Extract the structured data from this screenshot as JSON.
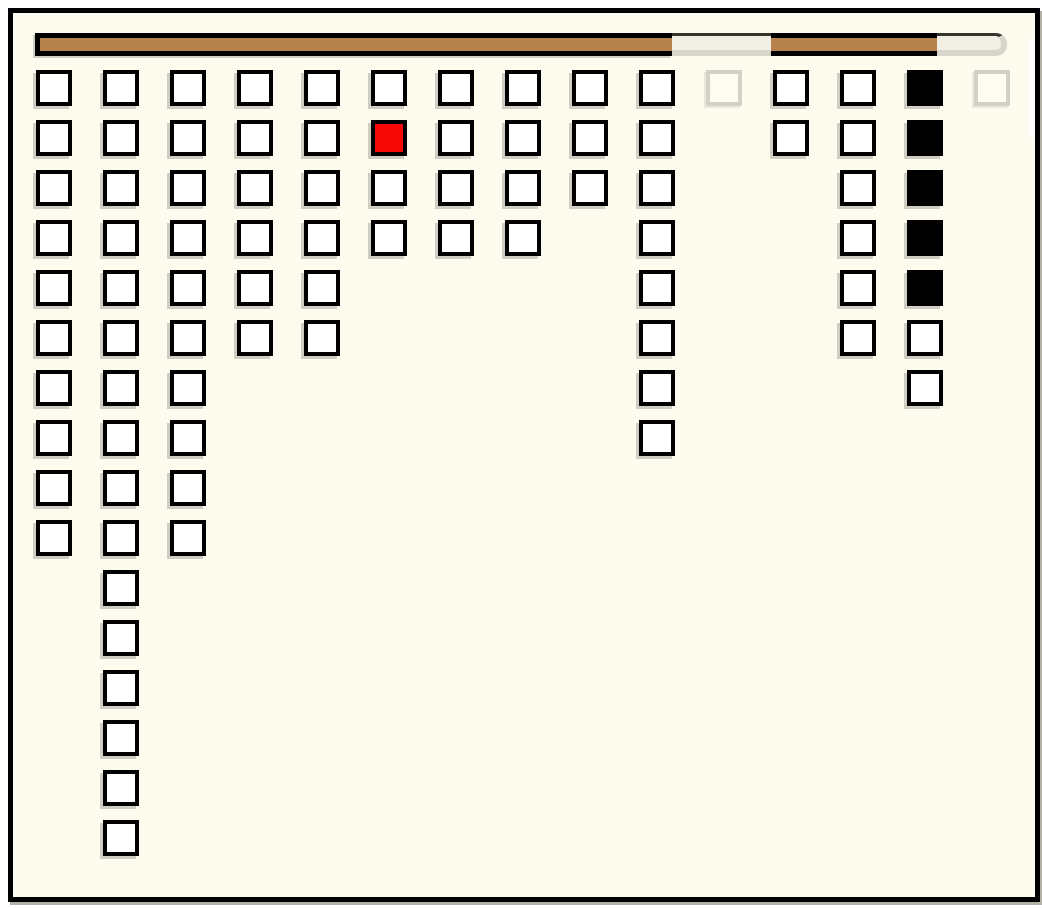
{
  "window": {
    "kind": "game-board",
    "text": ""
  },
  "colors": {
    "background": "#fcfbee",
    "outside": "#ffffff",
    "window_border": "#000000",
    "frame_shadow": "#b3b1a8",
    "cell_fill": "#ffffff",
    "cell_border": "#000000",
    "cell_red": "#f90808",
    "cell_black": "#000000",
    "ghost_border": "#d3d0c5",
    "ghost_fill": "#fdfcf1",
    "cell_shadow": "#d0cdc2",
    "bar_fill": "#b5824c",
    "bar_frame": "#000000",
    "track_fill": "#f1eee3",
    "track_rim": "#d8d5ca",
    "track_topline": "#35342f",
    "notch": "#ffffff"
  },
  "progress_bar": {
    "track": {
      "x": 35,
      "y": 33,
      "width": 972,
      "height": 23,
      "rounded_right_end": true
    },
    "segments": [
      {
        "type": "filled",
        "x": 35,
        "width": 637,
        "left_cap": true
      },
      {
        "type": "empty",
        "x": 672,
        "width": 99
      },
      {
        "type": "filled",
        "x": 771,
        "width": 166
      },
      {
        "type": "empty",
        "x": 937,
        "width": 70,
        "rounded_end": true
      }
    ]
  },
  "board": {
    "column_count": 15,
    "max_rows": 16,
    "total_cells": 88,
    "column_heights": [
      10,
      16,
      10,
      6,
      6,
      4,
      4,
      4,
      3,
      8,
      1,
      2,
      6,
      7,
      1
    ],
    "special_cells": {
      "red": {
        "column": 6,
        "row": 2
      },
      "black_column": {
        "column": 14,
        "rows": [
          1,
          2,
          3,
          4,
          5
        ]
      },
      "ghost_cells": [
        {
          "column": 11,
          "row": 1
        },
        {
          "column": 15,
          "row": 1
        }
      ]
    },
    "columns": [
      {
        "name": "col-1",
        "cells": [
          "normal",
          "normal",
          "normal",
          "normal",
          "normal",
          "normal",
          "normal",
          "normal",
          "normal",
          "normal"
        ]
      },
      {
        "name": "col-2",
        "cells": [
          "normal",
          "normal",
          "normal",
          "normal",
          "normal",
          "normal",
          "normal",
          "normal",
          "normal",
          "normal",
          "normal",
          "normal",
          "normal",
          "normal",
          "normal",
          "normal"
        ]
      },
      {
        "name": "col-3",
        "cells": [
          "normal",
          "normal",
          "normal",
          "normal",
          "normal",
          "normal",
          "normal",
          "normal",
          "normal",
          "normal"
        ]
      },
      {
        "name": "col-4",
        "cells": [
          "normal",
          "normal",
          "normal",
          "normal",
          "normal",
          "normal"
        ]
      },
      {
        "name": "col-5",
        "cells": [
          "normal",
          "normal",
          "normal",
          "normal",
          "normal",
          "normal"
        ]
      },
      {
        "name": "col-6",
        "cells": [
          "normal",
          "red",
          "normal",
          "normal"
        ]
      },
      {
        "name": "col-7",
        "cells": [
          "normal",
          "normal",
          "normal",
          "normal"
        ]
      },
      {
        "name": "col-8",
        "cells": [
          "normal",
          "normal",
          "normal",
          "normal"
        ]
      },
      {
        "name": "col-9",
        "cells": [
          "normal",
          "normal",
          "normal"
        ]
      },
      {
        "name": "col-10",
        "cells": [
          "normal",
          "normal",
          "normal",
          "normal",
          "normal",
          "normal",
          "normal",
          "normal"
        ]
      },
      {
        "name": "col-11",
        "cells": [
          "ghost"
        ]
      },
      {
        "name": "col-12",
        "cells": [
          "normal",
          "normal"
        ]
      },
      {
        "name": "col-13",
        "cells": [
          "normal",
          "normal",
          "normal",
          "normal",
          "normal",
          "normal"
        ]
      },
      {
        "name": "col-14",
        "cells": [
          "black",
          "black",
          "black",
          "black",
          "black",
          "normal",
          "normal"
        ]
      },
      {
        "name": "col-15",
        "cells": [
          "ghost"
        ]
      }
    ]
  }
}
